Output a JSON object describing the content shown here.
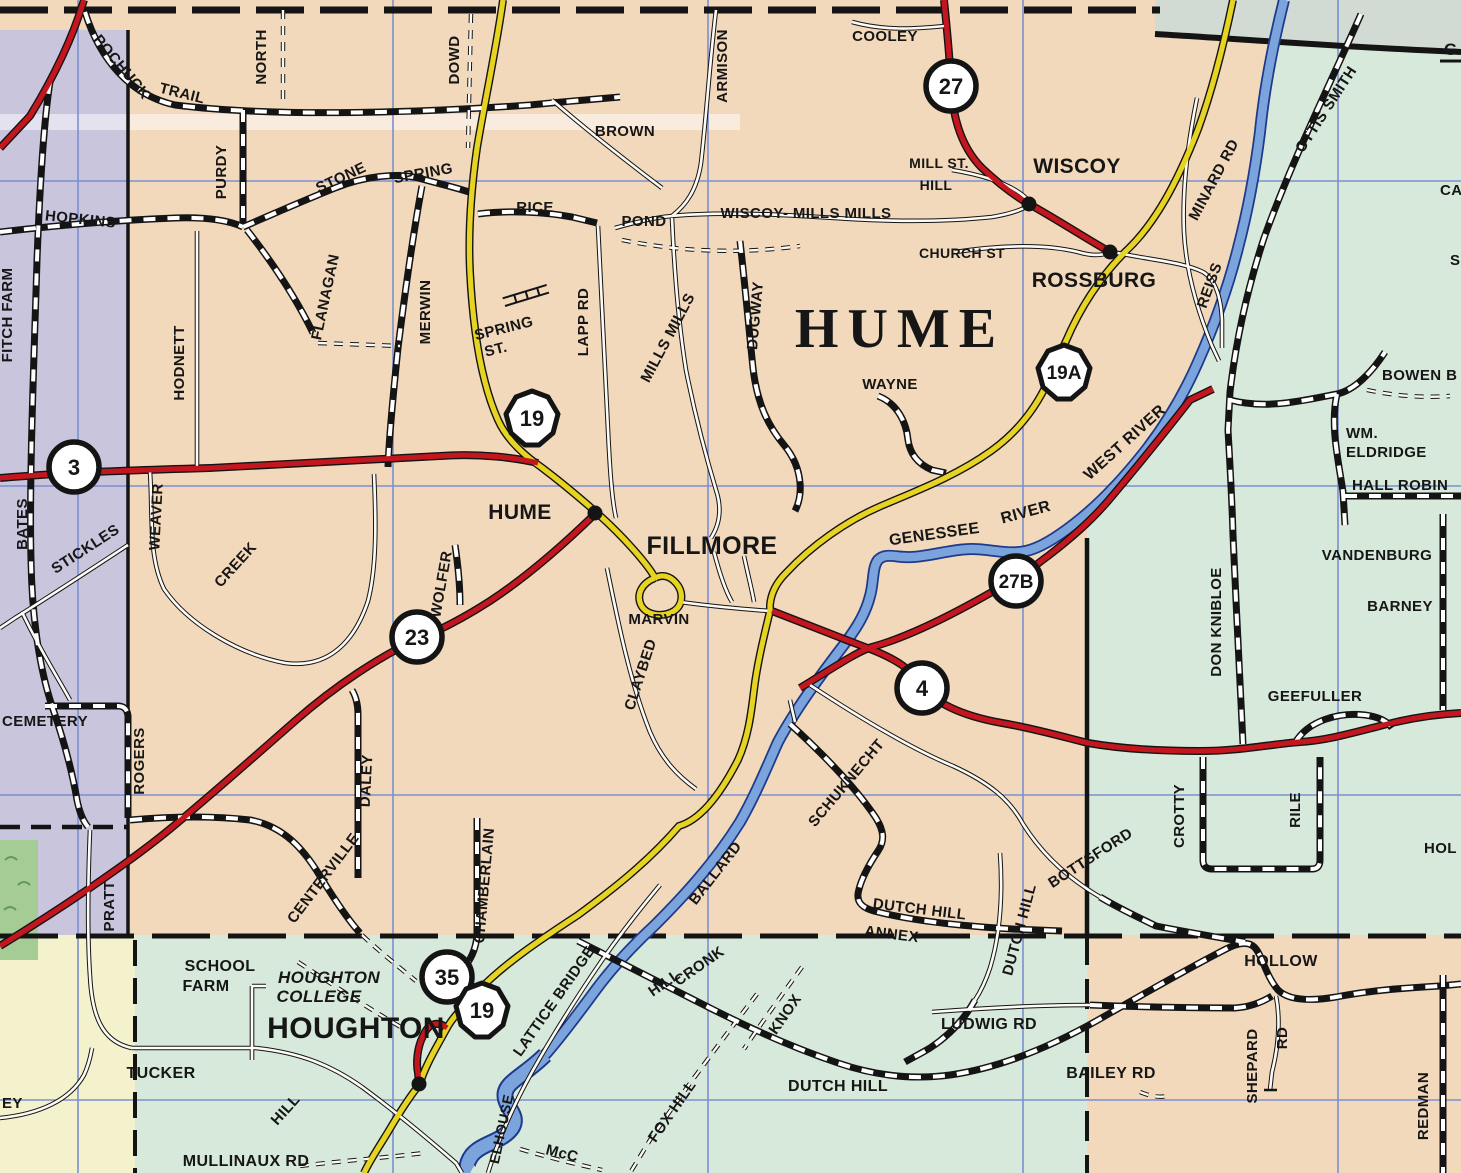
{
  "map": {
    "description": "County road map of Hume / Fillmore / Houghton area along the Genessee River",
    "colors": {
      "township_peach": "#f3d9bc",
      "township_lavender": "#c9c5dd",
      "township_green": "#d7e9da",
      "township_cream": "#f4f1cd",
      "scan_margin": "#d2dbd3",
      "river_blue": "#7ba3dc",
      "river_casing": "#1d3a8c",
      "road_red": "#c4161f",
      "road_yellow": "#e7d422",
      "road_black": "#141414",
      "grid_blue": "#7b8fd0",
      "vegetation_green": "#a6cc95"
    },
    "township_label": "HUME",
    "villages": [
      {
        "name": "WISCOY",
        "x": 1077,
        "y": 166
      },
      {
        "name": "ROSSBURG",
        "x": 1094,
        "y": 280
      },
      {
        "name": "HUME",
        "x": 520,
        "y": 512
      },
      {
        "name": "FILLMORE",
        "x": 712,
        "y": 547
      },
      {
        "name": "HOUGHTON",
        "x": 356,
        "y": 1031
      }
    ],
    "town_dots": [
      {
        "name": "wiscoy-dot",
        "x": 1029,
        "y": 204
      },
      {
        "name": "rossburg-dot",
        "x": 1110,
        "y": 252
      },
      {
        "name": "hume-dot",
        "x": 595,
        "y": 513
      },
      {
        "name": "houghton-dot",
        "x": 419,
        "y": 1084
      }
    ],
    "route_shields": [
      {
        "type": "circle",
        "route": "3",
        "x": 74,
        "y": 467
      },
      {
        "type": "circle",
        "route": "27",
        "x": 951,
        "y": 86
      },
      {
        "type": "circle",
        "route": "23",
        "x": 417,
        "y": 637
      },
      {
        "type": "circle",
        "route": "27B",
        "x": 1016,
        "y": 581
      },
      {
        "type": "circle",
        "route": "4",
        "x": 922,
        "y": 688
      },
      {
        "type": "circle",
        "route": "35",
        "x": 447,
        "y": 977
      },
      {
        "type": "ny",
        "route": "19",
        "x": 532,
        "y": 418
      },
      {
        "type": "ny",
        "route": "19A",
        "x": 1064,
        "y": 372
      },
      {
        "type": "ny",
        "route": "19",
        "x": 482,
        "y": 1010
      }
    ],
    "road_labels": [
      {
        "t": "POCHUCK",
        "x": 118,
        "y": 70,
        "r": 50,
        "s": 15
      },
      {
        "t": "TRAIL",
        "x": 181,
        "y": 98,
        "r": 14,
        "s": 15
      },
      {
        "t": "NORTH",
        "x": 266,
        "y": 57,
        "r": -90,
        "s": 15
      },
      {
        "t": "DOWD",
        "x": 459,
        "y": 60,
        "r": -90,
        "s": 15
      },
      {
        "t": "PURDY",
        "x": 226,
        "y": 172,
        "r": -90,
        "s": 15
      },
      {
        "t": "HOPKINS",
        "x": 80,
        "y": 224,
        "r": 6,
        "s": 15
      },
      {
        "t": "STONE",
        "x": 343,
        "y": 182,
        "r": -25,
        "s": 15
      },
      {
        "t": "SPRING",
        "x": 424,
        "y": 178,
        "r": -10,
        "s": 15
      },
      {
        "t": "FITCH FARM",
        "x": 12,
        "y": 315,
        "r": -90,
        "s": 15
      },
      {
        "t": "HODNETT",
        "x": 184,
        "y": 363,
        "r": -90,
        "s": 15
      },
      {
        "t": "FLANAGAN",
        "x": 330,
        "y": 298,
        "r": -78,
        "s": 15
      },
      {
        "t": "MERWIN",
        "x": 430,
        "y": 312,
        "r": -90,
        "s": 15
      },
      {
        "t": "RICE",
        "x": 535,
        "y": 212,
        "r": 0,
        "s": 15
      },
      {
        "t": "POND",
        "x": 644,
        "y": 226,
        "r": 0,
        "s": 15
      },
      {
        "t": "BROWN",
        "x": 625,
        "y": 136,
        "r": 0,
        "s": 15
      },
      {
        "t": "ARMISON",
        "x": 727,
        "y": 66,
        "r": -90,
        "s": 15
      },
      {
        "t": "COOLEY",
        "x": 885,
        "y": 41,
        "r": 0,
        "s": 15
      },
      {
        "t": "WISCOY- MILLS MILLS",
        "x": 806,
        "y": 218,
        "r": 0,
        "s": 15
      },
      {
        "t": "MILL ST.",
        "x": 939,
        "y": 168,
        "r": 0,
        "s": 14
      },
      {
        "t": "HILL",
        "x": 936,
        "y": 190,
        "r": 0,
        "s": 14
      },
      {
        "t": "CHURCH ST",
        "x": 962,
        "y": 258,
        "r": 0,
        "s": 14
      },
      {
        "t": "OTTIS SMITH",
        "x": 1330,
        "y": 112,
        "r": -57,
        "s": 15
      },
      {
        "t": "MINARD RD",
        "x": 1218,
        "y": 182,
        "r": -62,
        "s": 15
      },
      {
        "t": "REISS",
        "x": 1214,
        "y": 287,
        "r": -70,
        "s": 15
      },
      {
        "t": "G",
        "x": 1444,
        "y": 55,
        "r": 0,
        "s": 17,
        "a": "start"
      },
      {
        "t": "CAR",
        "x": 1440,
        "y": 195,
        "r": 0,
        "s": 15,
        "a": "start"
      },
      {
        "t": "S",
        "x": 1450,
        "y": 265,
        "r": 0,
        "s": 15,
        "a": "start"
      },
      {
        "t": "SPRING",
        "x": 505,
        "y": 333,
        "r": -14,
        "s": 15
      },
      {
        "t": "ST.",
        "x": 497,
        "y": 354,
        "r": -14,
        "s": 15
      },
      {
        "t": "LAPP RD",
        "x": 588,
        "y": 322,
        "r": -90,
        "s": 15
      },
      {
        "t": "MILLS MILLS",
        "x": 672,
        "y": 340,
        "r": -62,
        "s": 15
      },
      {
        "t": "DUGWAY",
        "x": 760,
        "y": 316,
        "r": -85,
        "s": 15
      },
      {
        "t": "WAYNE",
        "x": 890,
        "y": 389,
        "r": 0,
        "s": 15
      },
      {
        "t": "WEST RIVER",
        "x": 1128,
        "y": 446,
        "r": -42,
        "s": 16
      },
      {
        "t": "WM.",
        "x": 1346,
        "y": 438,
        "r": 0,
        "s": 15,
        "a": "start"
      },
      {
        "t": "ELDRIDGE",
        "x": 1346,
        "y": 457,
        "r": 0,
        "s": 15,
        "a": "start"
      },
      {
        "t": "HALL ROBIN",
        "x": 1352,
        "y": 490,
        "r": 0,
        "s": 15,
        "a": "start"
      },
      {
        "t": "BOWEN B",
        "x": 1382,
        "y": 380,
        "r": 0,
        "s": 15,
        "a": "start"
      },
      {
        "t": "VANDENBURG",
        "x": 1377,
        "y": 560,
        "r": 0,
        "s": 15
      },
      {
        "t": "BARNEY",
        "x": 1400,
        "y": 611,
        "r": 0,
        "s": 15
      },
      {
        "t": "DON KNIBLOE",
        "x": 1221,
        "y": 622,
        "r": -90,
        "s": 15
      },
      {
        "t": "GEEFULLER",
        "x": 1315,
        "y": 701,
        "r": 0,
        "s": 15
      },
      {
        "t": "CROTTY",
        "x": 1184,
        "y": 816,
        "r": -90,
        "s": 15
      },
      {
        "t": "RILE",
        "x": 1300,
        "y": 810,
        "r": -90,
        "s": 15
      },
      {
        "t": "HOL",
        "x": 1424,
        "y": 853,
        "r": 0,
        "s": 15,
        "a": "start"
      },
      {
        "t": "GENESSEE",
        "x": 935,
        "y": 539,
        "r": -8,
        "s": 16
      },
      {
        "t": "RIVER",
        "x": 1027,
        "y": 517,
        "r": -15,
        "s": 16
      },
      {
        "t": "WEAVER",
        "x": 161,
        "y": 517,
        "r": -87,
        "s": 15
      },
      {
        "t": "CREEK",
        "x": 239,
        "y": 568,
        "r": -48,
        "s": 15
      },
      {
        "t": "STICKLES",
        "x": 88,
        "y": 553,
        "r": -33,
        "s": 15
      },
      {
        "t": "BATES",
        "x": 27,
        "y": 524,
        "r": -90,
        "s": 15
      },
      {
        "t": "WOLFER",
        "x": 446,
        "y": 585,
        "r": -80,
        "s": 15
      },
      {
        "t": "MARVIN",
        "x": 659,
        "y": 624,
        "r": 0,
        "s": 15
      },
      {
        "t": "CLAYBED",
        "x": 645,
        "y": 676,
        "r": -72,
        "s": 15
      },
      {
        "t": "DALEY",
        "x": 371,
        "y": 781,
        "r": -87,
        "s": 15
      },
      {
        "t": "ROGERS",
        "x": 144,
        "y": 761,
        "r": -90,
        "s": 15
      },
      {
        "t": "CEMETERY",
        "x": 2,
        "y": 726,
        "r": 0,
        "s": 15,
        "a": "start"
      },
      {
        "t": "PRATT",
        "x": 114,
        "y": 906,
        "r": -90,
        "s": 15
      },
      {
        "t": "CENTERVILLE",
        "x": 327,
        "y": 881,
        "r": -53,
        "s": 15
      },
      {
        "t": "CHAMBERLAIN",
        "x": 489,
        "y": 886,
        "r": -85,
        "s": 15
      },
      {
        "t": "BALLARD",
        "x": 719,
        "y": 876,
        "r": -52,
        "s": 15
      },
      {
        "t": "SCHUKNECHT",
        "x": 850,
        "y": 786,
        "r": -50,
        "s": 15
      },
      {
        "t": "BOTTSFORD",
        "x": 1093,
        "y": 862,
        "r": -33,
        "s": 15
      },
      {
        "t": "DUTCH HILL",
        "x": 919,
        "y": 914,
        "r": 7,
        "s": 15
      },
      {
        "t": "ANNEX",
        "x": 891,
        "y": 939,
        "r": 7,
        "s": 15
      },
      {
        "t": "DUTCH HILL",
        "x": 1024,
        "y": 931,
        "r": -75,
        "s": 15
      },
      {
        "t": "SCHOOL",
        "x": 220,
        "y": 971,
        "r": 0,
        "s": 16
      },
      {
        "t": "FARM",
        "x": 206,
        "y": 991,
        "r": 0,
        "s": 16
      },
      {
        "t": "TUCKER",
        "x": 161,
        "y": 1078,
        "r": 0,
        "s": 16
      },
      {
        "t": "HILL",
        "x": 289,
        "y": 1113,
        "r": -48,
        "s": 15
      },
      {
        "t": "MULLINAUX RD",
        "x": 246,
        "y": 1166,
        "r": 0,
        "s": 16
      },
      {
        "t": "EY",
        "x": 2,
        "y": 1108,
        "r": 0,
        "s": 15,
        "a": "start"
      },
      {
        "t": "LATTICE BRIDGE",
        "x": 558,
        "y": 1004,
        "r": -55,
        "s": 15
      },
      {
        "t": "CRONK",
        "x": 702,
        "y": 970,
        "r": -35,
        "s": 15
      },
      {
        "t": "HILL",
        "x": 667,
        "y": 987,
        "r": -35,
        "s": 15
      },
      {
        "t": "KNOX",
        "x": 789,
        "y": 1017,
        "r": -55,
        "s": 15
      },
      {
        "t": "FOX HILL",
        "x": 676,
        "y": 1114,
        "r": -55,
        "s": 15
      },
      {
        "t": "DUTCH HILL",
        "x": 838,
        "y": 1091,
        "r": 0,
        "s": 16
      },
      {
        "t": "LUDWIG RD",
        "x": 989,
        "y": 1029,
        "r": 0,
        "s": 16
      },
      {
        "t": "BAILEY RD",
        "x": 1111,
        "y": 1078,
        "r": 0,
        "s": 16
      },
      {
        "t": "HOLLOW",
        "x": 1281,
        "y": 966,
        "r": 0,
        "s": 16
      },
      {
        "t": "SHEPARD",
        "x": 1257,
        "y": 1066,
        "r": -90,
        "s": 15
      },
      {
        "t": "RD",
        "x": 1287,
        "y": 1038,
        "r": -90,
        "s": 15
      },
      {
        "t": "REDMAN",
        "x": 1428,
        "y": 1106,
        "r": -90,
        "s": 15
      },
      {
        "t": "McC",
        "x": 561,
        "y": 1158,
        "r": 14,
        "s": 15
      },
      {
        "t": "ELHOUSE",
        "x": 506,
        "y": 1130,
        "r": -78,
        "s": 14
      }
    ],
    "institution_labels": [
      {
        "t": "HOUGHTON",
        "x": 329,
        "y": 983,
        "r": 0,
        "s": 17,
        "st": "ital"
      },
      {
        "t": "COLLEGE",
        "x": 319,
        "y": 1002,
        "r": 0,
        "s": 17,
        "st": "ital"
      }
    ],
    "big_labels": [
      {
        "t": "HUME",
        "x": 900,
        "y": 347,
        "s": 56,
        "st": "serif"
      }
    ]
  }
}
